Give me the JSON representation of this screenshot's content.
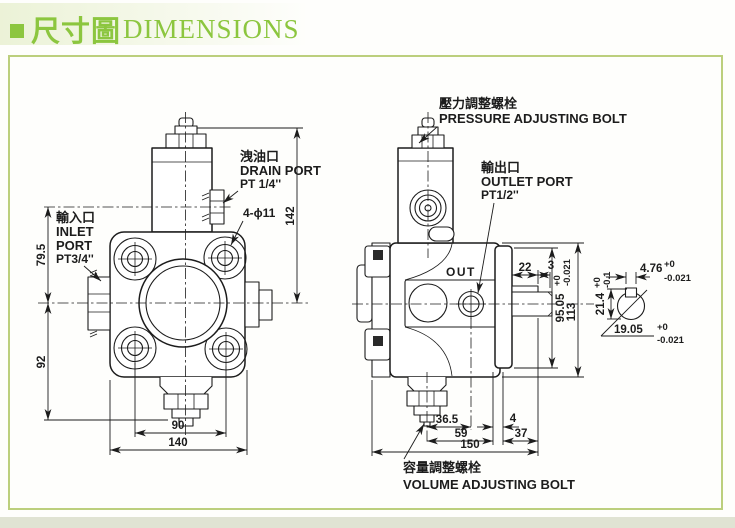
{
  "colors": {
    "accent_green": "#8cc63f",
    "frame_border": "#bccf7d",
    "line_color": "#1c1c1c",
    "strip": "#e0e3d3"
  },
  "header": {
    "title_zh": "尺寸圖",
    "title_en": "DIMENSIONS"
  },
  "front_view": {
    "labels": {
      "drain_zh": "洩油口",
      "drain_en": "DRAIN PORT",
      "drain_size": "PT 1/4''",
      "inlet_zh": "輸入口",
      "inlet_en_line1": "INLET",
      "inlet_en_line2": "PORT",
      "inlet_size": "PT3/4''",
      "bolt_holes": "4-ϕ11"
    },
    "dims": {
      "overall_height": "142",
      "center_to_drain": "79.5",
      "center_to_bottom": "92",
      "bolt_spacing": "90",
      "overall_width": "140"
    }
  },
  "side_view": {
    "labels": {
      "pressure_zh": "壓力調整螺栓",
      "pressure_en": "PRESSURE ADJUSTING BOLT",
      "outlet_zh": "輸出口",
      "outlet_en": "OUTLET PORT",
      "outlet_size": "PT1/2''",
      "volume_zh": "容量調整螺栓",
      "volume_en": "VOLUME ADJUSTING BOLT",
      "out_marking": "OUT"
    },
    "dims": {
      "key_length": "22",
      "key_offset": "3",
      "spigot": "95.05",
      "spigot_tol_plus": "+0",
      "spigot_tol_minus": "-0.021",
      "body_height": "113",
      "bolt_to_outlet": "36.5",
      "bolt_to_flange": "59",
      "overall_length": "150",
      "gap": "4",
      "shaft_length": "37"
    }
  },
  "shaft_detail": {
    "dims": {
      "key_width": "4.76",
      "key_width_tol_plus": "+0",
      "key_width_tol_minus": "-0.021",
      "shaft_height": "21.4",
      "shaft_height_tol_plus": "+0",
      "shaft_height_tol_minus": "-0.1",
      "shaft_dia": "19.05",
      "shaft_dia_tol_plus": "+0",
      "shaft_dia_tol_minus": "-0.021"
    }
  }
}
